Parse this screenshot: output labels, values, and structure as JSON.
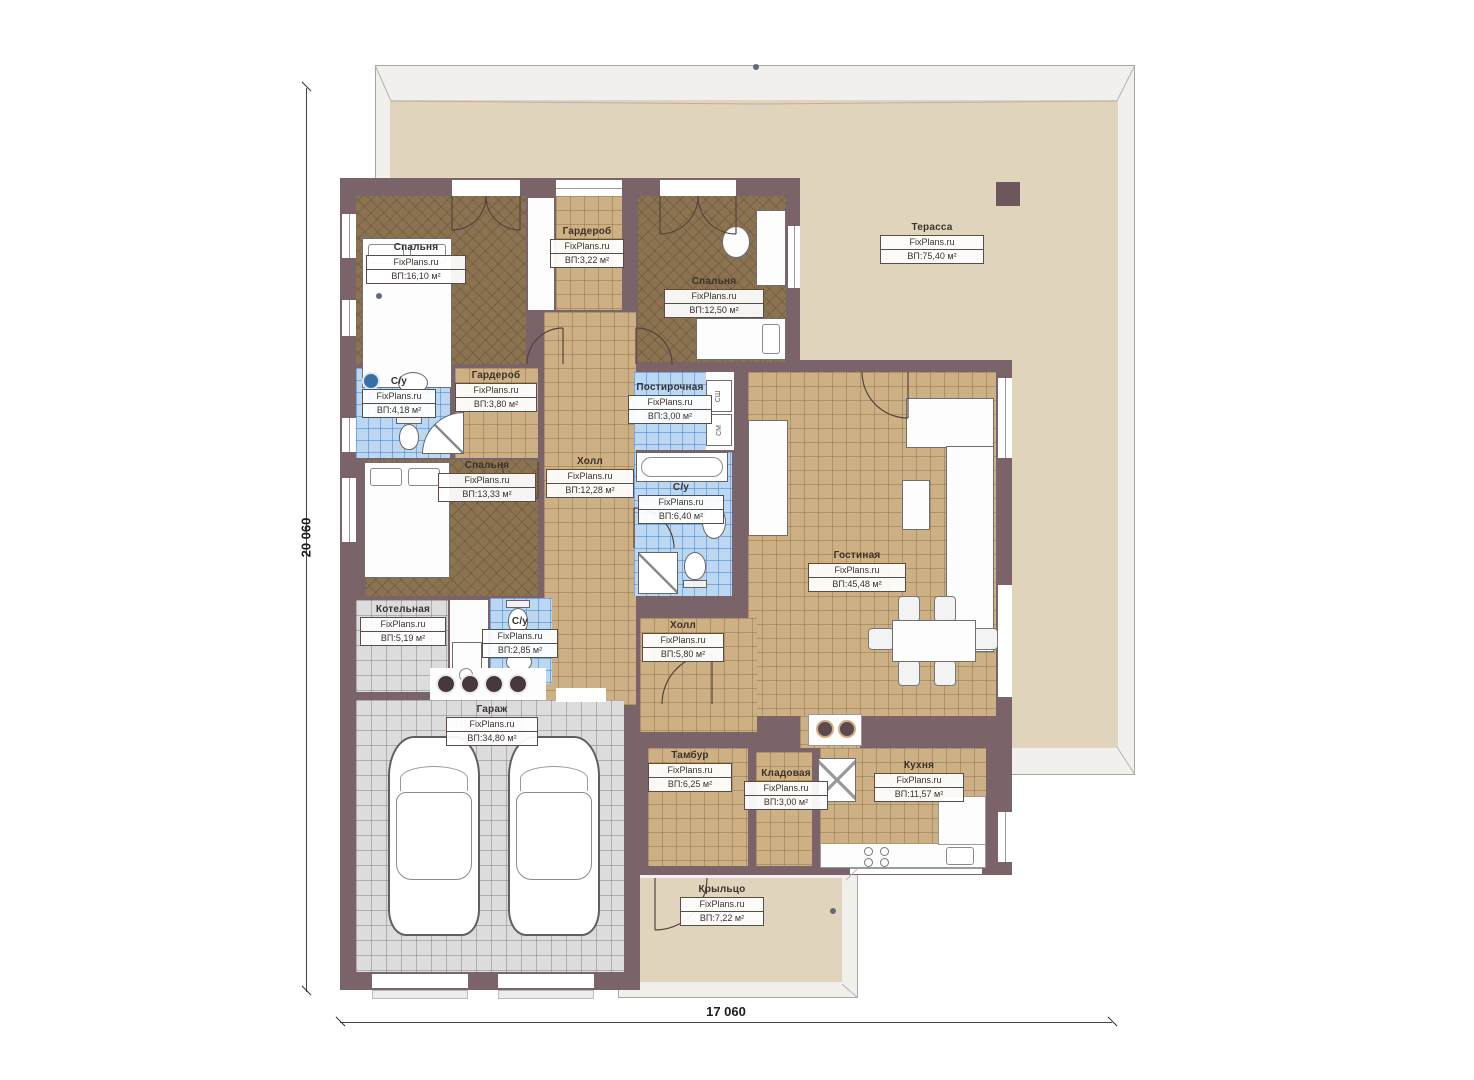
{
  "watermark": "FixPlans.ru",
  "dimensions": {
    "left_vertical": "20 060",
    "bottom_horizontal": "17 060"
  },
  "rooms": [
    {
      "name": "Спальня",
      "area": "ВП:16,10 м²"
    },
    {
      "name": "Гардероб",
      "area": "ВП:3,22 м²"
    },
    {
      "name": "Спальня",
      "area": "ВП:12,50 м²"
    },
    {
      "name": "Терасса",
      "area": "ВП:75,40 м²"
    },
    {
      "name": "С/у",
      "area": "ВП:4,18 м²"
    },
    {
      "name": "Гардероб",
      "area": "ВП:3,80 м²"
    },
    {
      "name": "Постирочная",
      "area": "ВП:3,00 м²"
    },
    {
      "name": "Спальня",
      "area": "ВП:13,33 м²"
    },
    {
      "name": "Холл",
      "area": "ВП:12,28 м²"
    },
    {
      "name": "С/у",
      "area": "ВП:6,40 м²"
    },
    {
      "name": "Гостиная",
      "area": "ВП:45,48 м²"
    },
    {
      "name": "Котельная",
      "area": "ВП:5,19 м²"
    },
    {
      "name": "С/у",
      "area": "ВП:2,85 м²"
    },
    {
      "name": "Холл",
      "area": "ВП:5,80 м²"
    },
    {
      "name": "Гараж",
      "area": "ВП:34,80 м²"
    },
    {
      "name": "Тамбур",
      "area": "ВП:6,25 м²"
    },
    {
      "name": "Кладовая",
      "area": "ВП:3,00 м²"
    },
    {
      "name": "Кухня",
      "area": "ВП:11,57 м²"
    },
    {
      "name": "Крыльцо",
      "area": "ВП:7,22 м²"
    }
  ],
  "appliances": {
    "dryer": "СШ",
    "washer": "СМ"
  },
  "colors": {
    "wall": "#7a646a",
    "tile_tan": "#cdb084",
    "tile_brown": "#8b7352",
    "tile_blue": "#bcd8f0",
    "tile_gray": "#dcdcdc",
    "terrace": "#e1d4bd"
  }
}
